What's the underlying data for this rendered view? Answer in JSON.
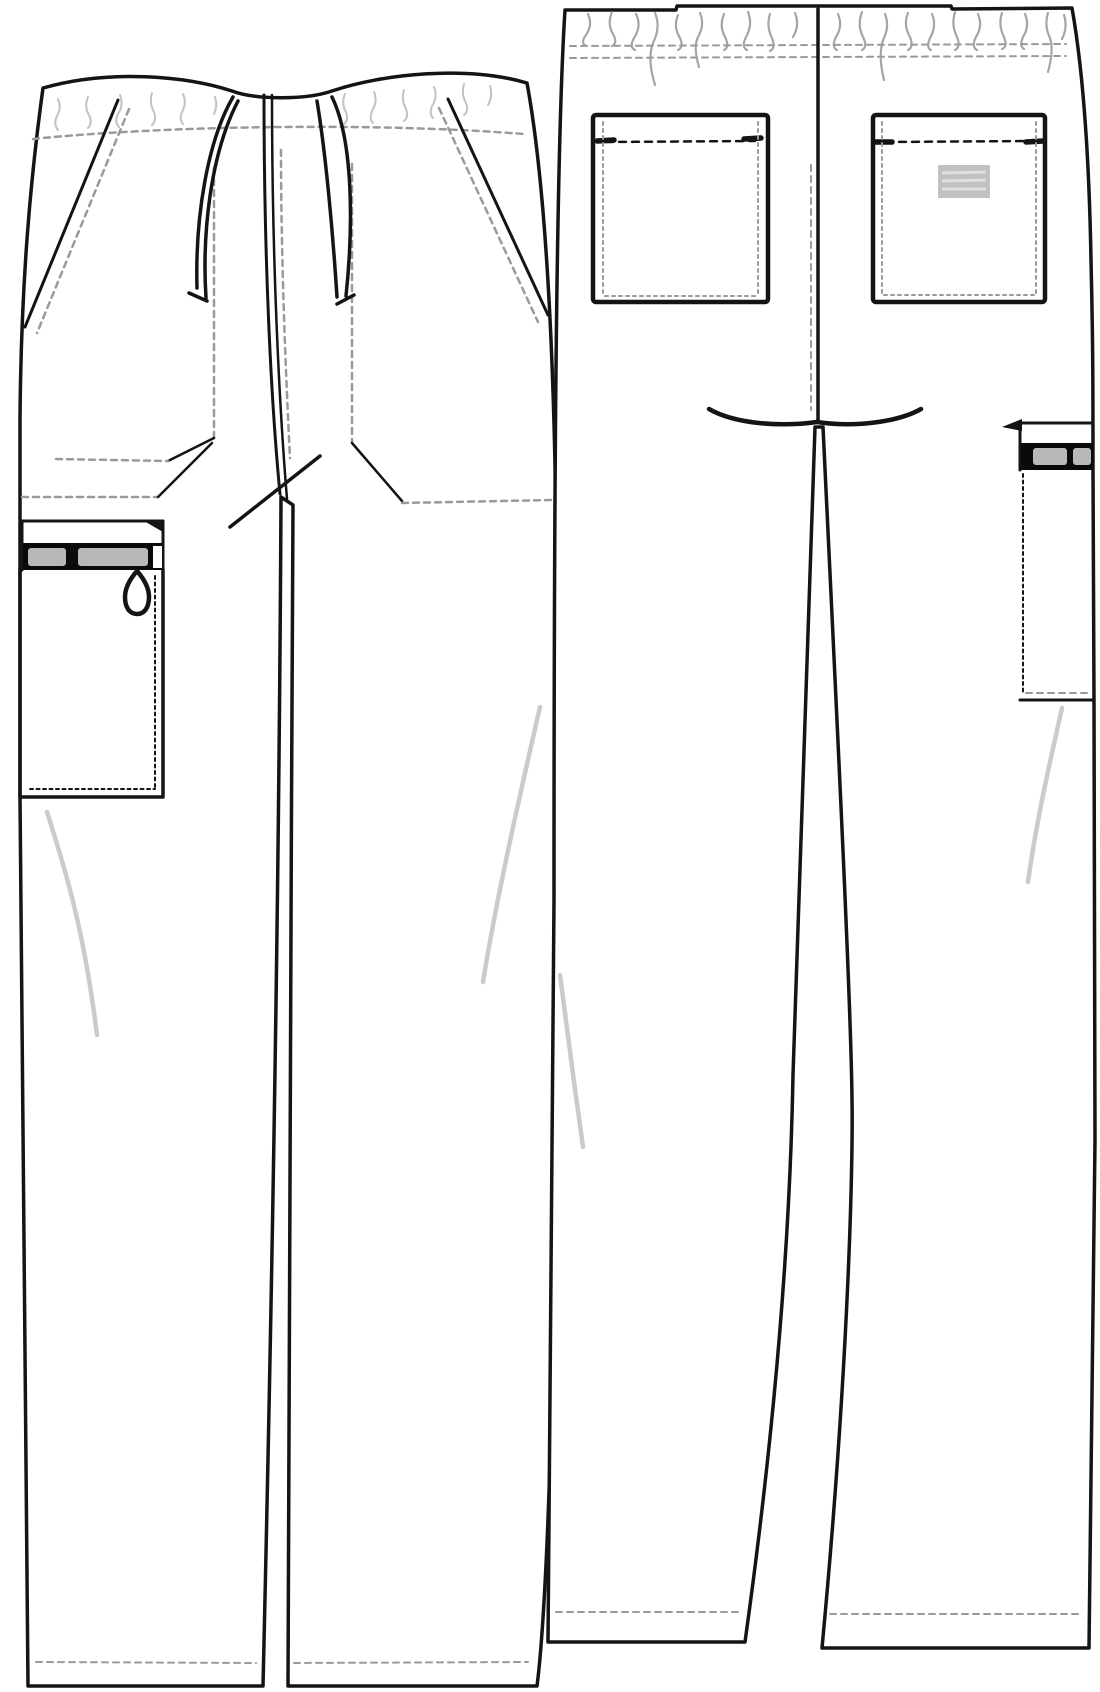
{
  "document": {
    "kind": "garment-technical-flat-sketch",
    "subject": "drawstring cargo scrub pants",
    "views": [
      {
        "id": "front-view",
        "label": "front"
      },
      {
        "id": "back-view",
        "label": "back"
      }
    ]
  },
  "colors": {
    "background": "#ffffff",
    "line": "#141414",
    "stitch_gray": "#9a9a9a",
    "shade_gray": "#cbcbcb",
    "zipper_tape": "#b8b8b8",
    "band": "#0a0a0a",
    "label_fill": "#c2c2c2",
    "label_stripe": "#e0e0e0",
    "gather_gray": "#8f8f8f"
  },
  "front_view": {
    "label": "front",
    "parts": [
      "waistband-with-gathers",
      "waistband-stitch-line",
      "drawstring-left-loop",
      "drawstring-right-loop",
      "center-front-seam",
      "fly-stitch-dashed",
      "crotch-bartack-slash",
      "left-slash-pocket",
      "right-slash-pocket",
      "left-pocket-bag",
      "right-pocket-bag",
      "left-cargo-zip-pocket",
      "zipper-tape",
      "zipper-pull-loop",
      "left-leg",
      "right-leg",
      "hem-stitch-lines",
      "fabric-creases"
    ]
  },
  "back_view": {
    "label": "back",
    "parts": [
      "elastic-waistband-shirring",
      "waistband-stitch-lines",
      "center-back-seam",
      "center-back-stitch-dashed",
      "seat-curve",
      "left-patch-pocket",
      "right-patch-pocket",
      "pocket-bartacks",
      "woven-label",
      "side-cargo-pocket-partial",
      "zipper-tape",
      "left-leg",
      "right-leg",
      "hem-stitch-lines",
      "fabric-creases"
    ]
  }
}
